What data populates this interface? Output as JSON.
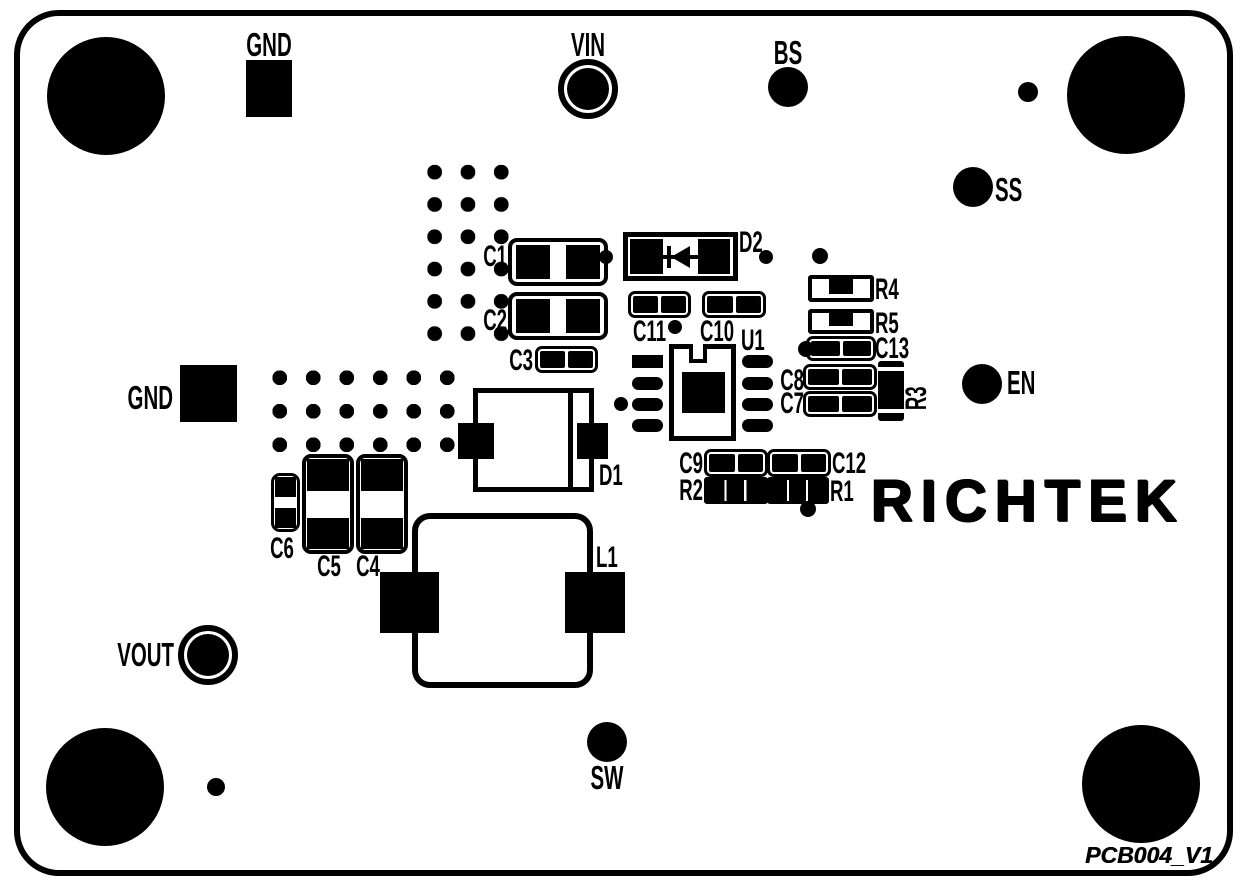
{
  "board": {
    "brand": "RICHTEK",
    "version": "PCB004_V1"
  },
  "test_points": {
    "gnd_top": "GND",
    "vin": "VIN",
    "bs": "BS",
    "ss": "SS",
    "en": "EN",
    "gnd_left": "GND",
    "vout": "VOUT",
    "sw": "SW"
  },
  "components": {
    "c1": "C1",
    "c2": "C2",
    "c3": "C3",
    "c4": "C4",
    "c5": "C5",
    "c6": "C6",
    "c7": "C7",
    "c8": "C8",
    "c9": "C9",
    "c10": "C10",
    "c11": "C11",
    "c12": "C12",
    "c13": "C13",
    "r1": "R1",
    "r2": "R2",
    "r3": "R3",
    "r4": "R4",
    "r5": "R5",
    "d1": "D1",
    "d2": "D2",
    "l1": "L1",
    "u1": "U1"
  },
  "colors": {
    "silkscreen": "#000000",
    "board": "#ffffff"
  }
}
